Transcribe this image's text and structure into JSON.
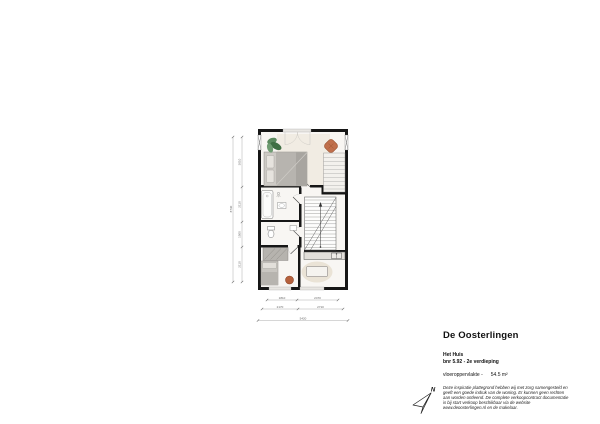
{
  "info": {
    "title": "De Oosterlingen",
    "building": "Het Huis",
    "unit": "bnr 5.92 - 2e verdieping",
    "area_label": "vloeroppervlakte -",
    "area_value": "54.5 m²",
    "disclaimer": "Deze inspiratie plattegrond hebben wij met zorg samengesteld en geeft een goede indruk van de woning. Er kunnen geen rechten aan worden ontleend. De complete verkoopcontract documentatie is bij start verkoop beschikbaar via de website www.deoosterlingen.nl en de makelaar."
  },
  "compass": {
    "label": "N"
  },
  "floorplan": {
    "floor_label": "2e verdieping",
    "dimensions": {
      "left_total": "8730",
      "left_segments": [
        "3010",
        "2110",
        "1500",
        "2110"
      ],
      "bottom_inner": [
        "1810",
        "2470"
      ],
      "bottom_mid": [
        "2170",
        "2710"
      ],
      "bottom_total": "5420"
    },
    "colors": {
      "wall": "#161616",
      "floor": "#f8f6f3",
      "bedroom_rug": "#f1ece3",
      "furniture_gray": "#b7b4af",
      "accent_terracotta": "#b5603c",
      "plant_green": "#4c7a50",
      "rug_beige": "#eae3d6",
      "dimension_gray": "#8f8f8f"
    }
  }
}
